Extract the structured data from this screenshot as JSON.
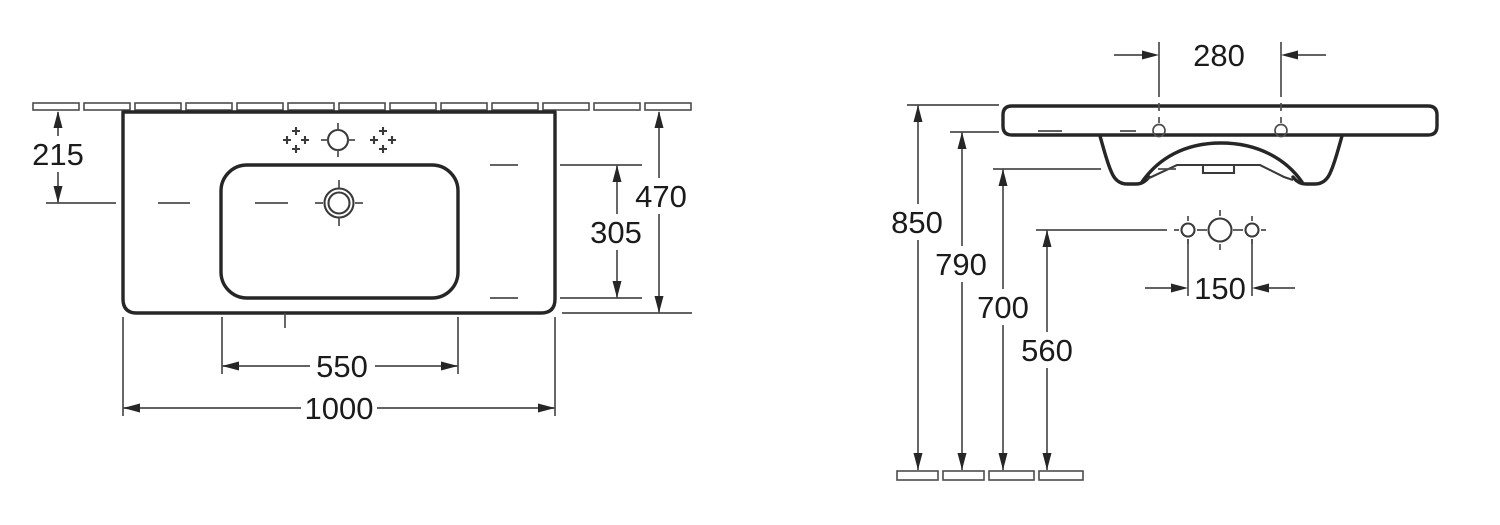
{
  "dims": {
    "top": {
      "wall_offset": "215",
      "depth_total": "470",
      "bowl_depth": "305",
      "bowl_width": "550",
      "width_total": "1000"
    },
    "front": {
      "fixing_hole_spacing": "280",
      "height_total": "850",
      "height_underside": "790",
      "height_front_edge": "700",
      "height_tap_holes": "560",
      "tap_hole_spacing": "150"
    }
  },
  "colors": {
    "outline": "#262626",
    "dimension_lines": "#4d4d4d",
    "background": "#ffffff"
  }
}
